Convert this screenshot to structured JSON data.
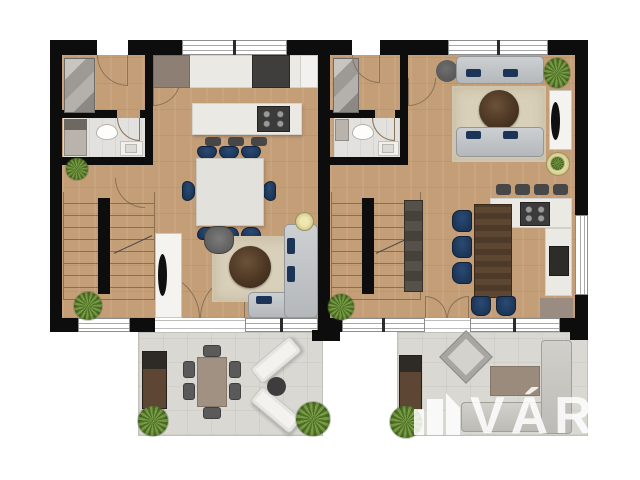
{
  "document": {
    "type": "residential floor plan, top-down 3D render",
    "units_visible": 2,
    "floors_shown": "ground floor of two attached dwelling units with rear terraces"
  },
  "watermark": {
    "text": "VÁROS",
    "logo": "city-buildings-logo"
  },
  "palette": {
    "wall": "#0d0d0d",
    "wood": "#c49e77",
    "tile": "#e3e1dd",
    "terrace": "#dad8d3",
    "counter": "#ebe9e4",
    "navy": "#1c3557",
    "sofa_gray": "#b4b8ba",
    "rug": "#d9d0ba",
    "dark_table": "#432f1d",
    "stool": "#474747",
    "grill_brown": "#5d4633",
    "arc": "#8a7358",
    "watermark": "rgba(255,255,255,0.85)"
  },
  "left_unit": {
    "rooms": [
      "entry-hall",
      "bathroom",
      "kitchen",
      "dining-area",
      "living-area",
      "staircase"
    ],
    "furniture": {
      "wardrobe": 1,
      "toilet": 1,
      "vanity_sink": 1,
      "washer": 1,
      "kitchen_counter_sections": 3,
      "cooking_island": 1,
      "cooktop_burners": 4,
      "bar_stools": 3,
      "dining_table": 1,
      "dining_chairs_navy": 8,
      "tv_cabinet": 1,
      "armchair": 1,
      "round_coffee_table": 1,
      "rug": 1,
      "corner_sofa": 1,
      "sofa_pillows_navy": 3,
      "floor_lamp": 1,
      "plants": 2
    }
  },
  "right_unit": {
    "rooms": [
      "entry-hall",
      "bathroom",
      "living-room",
      "kitchen-dining",
      "staircase"
    ],
    "furniture": {
      "wardrobe": 1,
      "toilet": 1,
      "vanity_sink": 1,
      "washer": 1,
      "sofas_gray": 2,
      "sofa_pillows_navy": 4,
      "round_coffee_table": 1,
      "rug": 1,
      "pouf": 1,
      "tv_cabinet": 1,
      "side_table": 1,
      "kitchen_counter_u": 1,
      "cooktop_burners": 4,
      "oven": 1,
      "bar_stools": 4,
      "wood_dining_table": 1,
      "dining_chairs_navy": 5,
      "tall_cabinet": 1,
      "plants": 2
    }
  },
  "terraces": {
    "left": {
      "items": [
        "grill-cabinet",
        "outdoor-dining-table",
        "outdoor-chairs-6",
        "white-loungers-2",
        "round-side-table",
        "plants-2"
      ]
    },
    "right": {
      "items": [
        "grill-cabinet",
        "diamond-lounger",
        "low-table",
        "l-shaped-outdoor-sofa",
        "plant-1"
      ]
    }
  }
}
